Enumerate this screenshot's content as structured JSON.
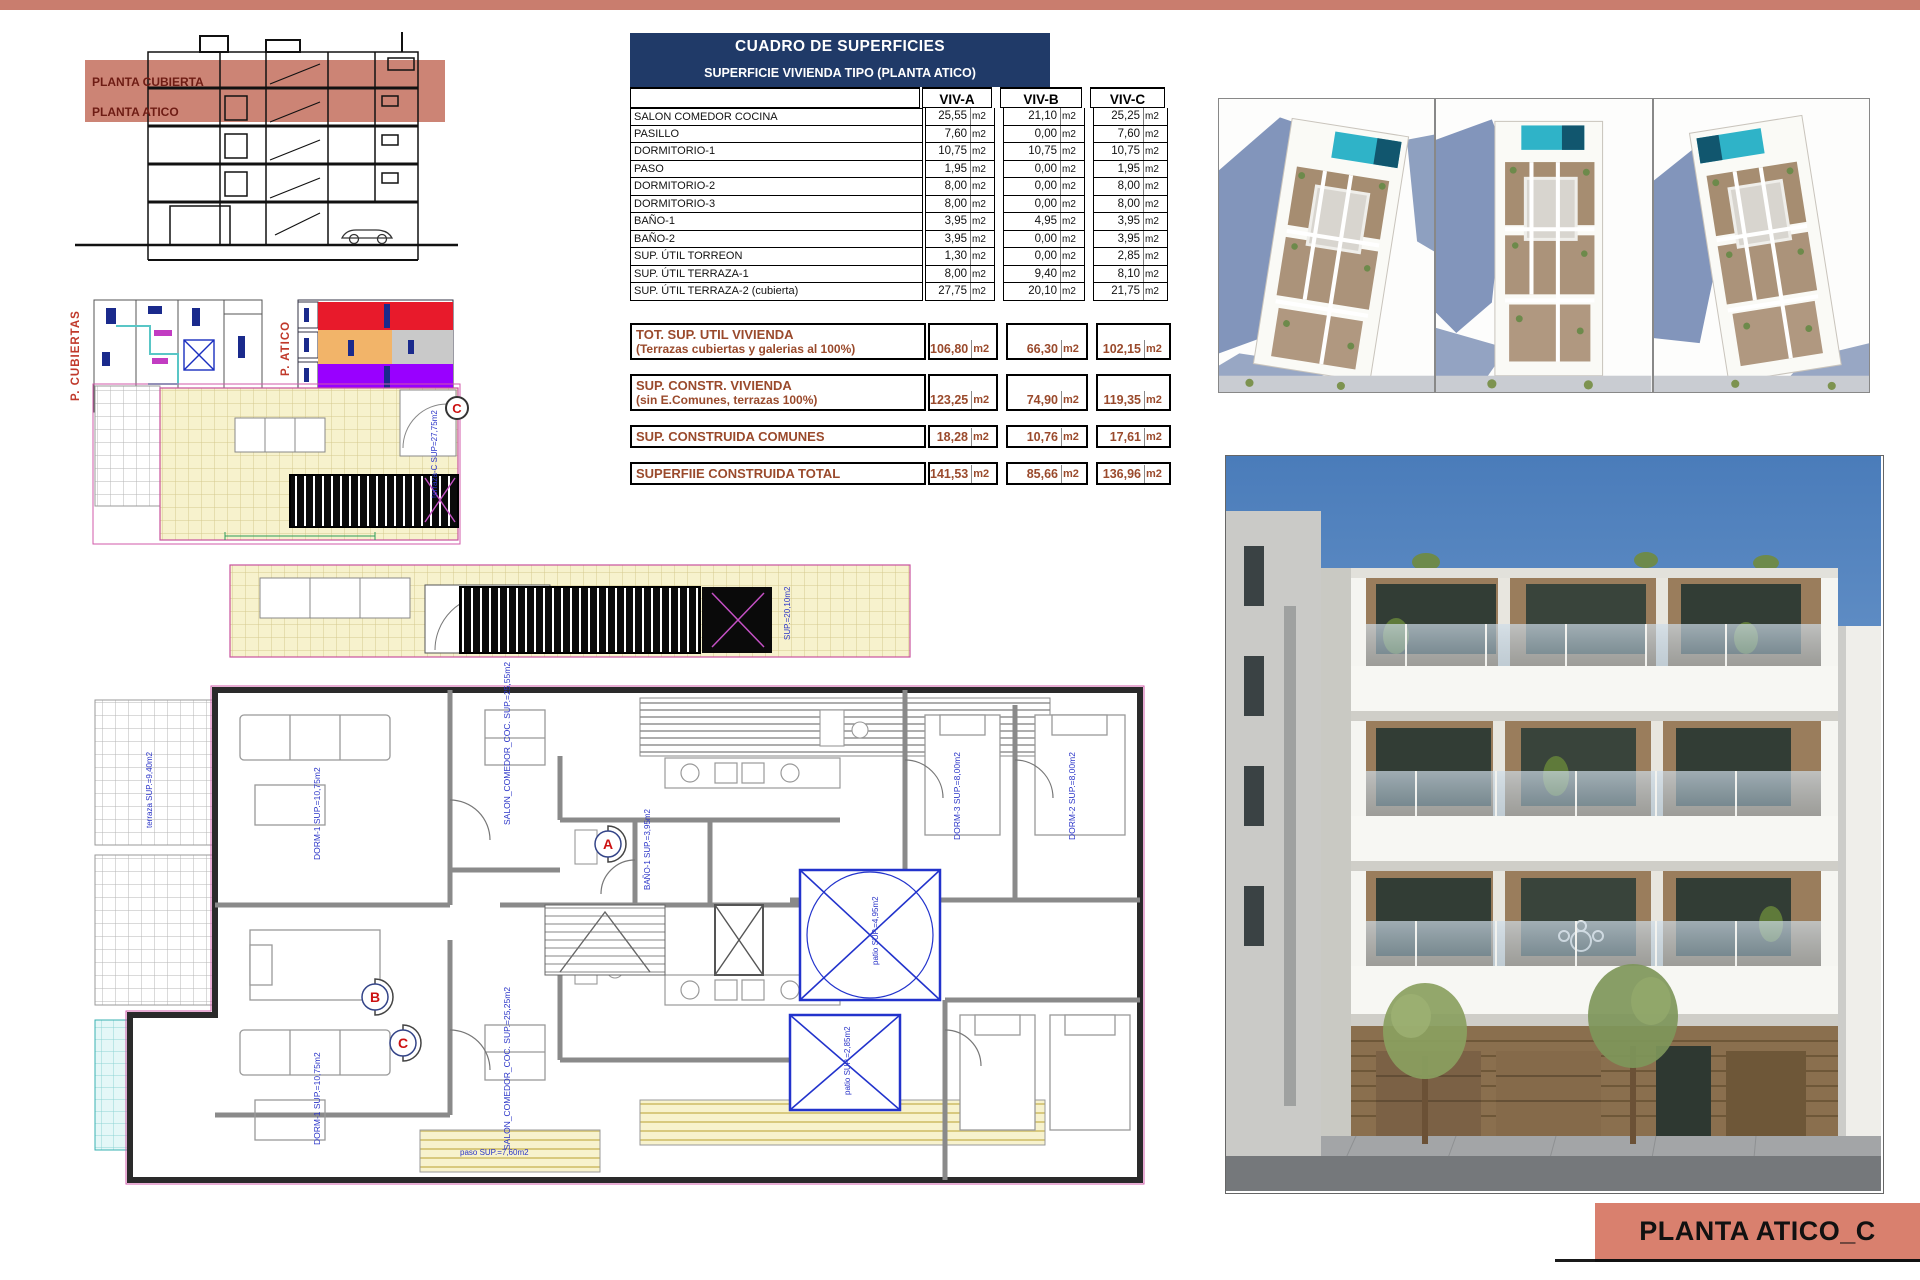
{
  "colors": {
    "salmon": "#c97d6e",
    "navy": "#203a68",
    "rust": "#9a4a2c",
    "pool_teal": "#2fb3c8",
    "sky_blue": "#4a7cba",
    "plan_yellow": "#f7f2cd",
    "plan_cyan": "#e4f7f7",
    "patio_blue": "#2233cc",
    "atico_red": "#e81a2b",
    "atico_orange": "#f2b469",
    "atico_purple": "#9900ff",
    "atico_gray": "#cccccc"
  },
  "section": {
    "label_cubierta": "PLANTA CUBIERTA",
    "label_atico": "PLANTA ATICO"
  },
  "mini_plans": {
    "cubiertas_label": "P. CUBIERTAS",
    "atico_label": "P. ATICO"
  },
  "surface_table": {
    "title": "CUADRO DE SUPERFICIES",
    "subtitle": "SUPERFICIE VIVIENDA TIPO  (PLANTA ATICO)",
    "columns": [
      "VIV-A",
      "VIV-B",
      "VIV-C"
    ],
    "unit": "m2",
    "rows": [
      {
        "label": "SALON COMEDOR COCINA",
        "a": "25,55",
        "b": "21,10",
        "c": "25,25"
      },
      {
        "label": "PASILLO",
        "a": "7,60",
        "b": "0,00",
        "c": "7,60"
      },
      {
        "label": "DORMITORIO-1",
        "a": "10,75",
        "b": "10,75",
        "c": "10,75"
      },
      {
        "label": "PASO",
        "a": "1,95",
        "b": "0,00",
        "c": "1,95"
      },
      {
        "label": "DORMITORIO-2",
        "a": "8,00",
        "b": "0,00",
        "c": "8,00"
      },
      {
        "label": "DORMITORIO-3",
        "a": "8,00",
        "b": "0,00",
        "c": "8,00"
      },
      {
        "label": "BAÑO-1",
        "a": "3,95",
        "b": "4,95",
        "c": "3,95"
      },
      {
        "label": "BAÑO-2",
        "a": "3,95",
        "b": "0,00",
        "c": "3,95"
      },
      {
        "label": "SUP. ÚTIL TORREON",
        "a": "1,30",
        "b": "0,00",
        "c": "2,85"
      },
      {
        "label": "SUP. ÚTIL TERRAZA-1",
        "a": "8,00",
        "b": "9,40",
        "c": "8,10"
      },
      {
        "label": "SUP. ÚTIL TERRAZA-2 (cubierta)",
        "a": "27,75",
        "b": "20,10",
        "c": "21,75"
      }
    ],
    "summaries": [
      {
        "line1": "TOT. SUP. UTIL VIVIENDA",
        "line2": "(Terrazas cubiertas y galerias al 100%)",
        "a": "106,80",
        "b": "66,30",
        "c": "102,15"
      },
      {
        "line1": "SUP. CONSTR. VIVIENDA",
        "line2": "(sin E.Comunes, terrazas 100%)",
        "a": "123,25",
        "b": "74,90",
        "c": "119,35"
      },
      {
        "line1": "SUP. CONSTRUIDA COMUNES",
        "line2": "",
        "a": "18,28",
        "b": "10,76",
        "c": "17,61"
      },
      {
        "line1": "SUPERFIIE CONSTRUIDA TOTAL",
        "line2": "",
        "a": "141,53",
        "b": "85,66",
        "c": "136,96"
      }
    ]
  },
  "roof_plan": {
    "marker": "C",
    "annotation": "terraza-C SUP=27,75m2"
  },
  "floor_plan": {
    "marker_a": "A",
    "marker_b": "B",
    "marker_c": "C",
    "annotations": {
      "salon_a": "SALON_COMEDOR_COC. SUP.=25,55m2",
      "dorm1_a": "DORM-1 SUP.=10,75m2",
      "bano1": "BAÑO-1 SUP.=3,95m2",
      "dorm3": "DORM-3 SUP.=8,00m2",
      "dorm2": "DORM-2 SUP.=8,00m2",
      "salon_c": "SALON_COMEDOR_COC. SUP.=25,25m2",
      "dorm1_c": "DORM-1 SUP.=10,75m2",
      "paso": "paso SUP.=7,60m2",
      "patio1": "patio SUP.=4,95m2",
      "patio2": "patio SUP.=2,85m2",
      "terraza_b": "terraza SUP.=9,40m2",
      "terraza_c2": "terraza SUP.=8,10m2"
    }
  },
  "footer": {
    "label": "PLANTA ATICO_C"
  }
}
